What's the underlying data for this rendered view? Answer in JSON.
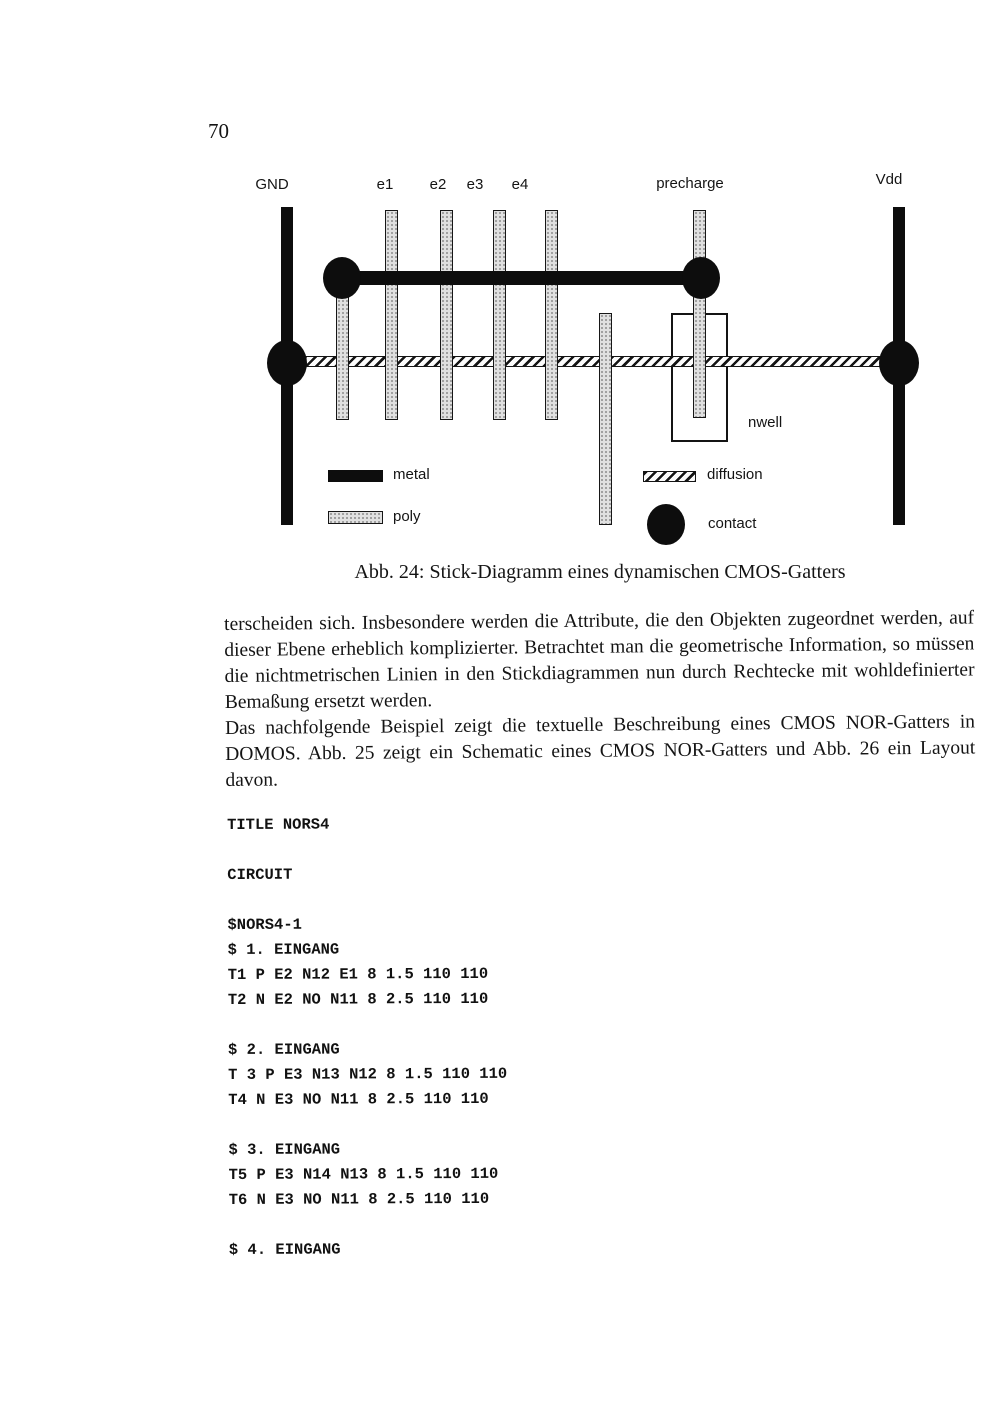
{
  "page": {
    "number": "70"
  },
  "diagram": {
    "signal_labels": {
      "gnd": "GND",
      "e1": "e1",
      "e2": "e2",
      "e3": "e3",
      "e4": "e4",
      "precharge": "precharge",
      "vdd": "Vdd"
    },
    "region_labels": {
      "nwell": "nwell"
    },
    "legend": {
      "metal": "metal",
      "poly": "poly",
      "diffusion": "diffusion",
      "contact": "contact"
    },
    "caption": "Abb. 24: Stick-Diagramm eines dynamischen CMOS-Gatters"
  },
  "body": {
    "paragraph1": "terscheiden sich. Insbesondere werden die Attribute, die den Objekten zugeordnet werden, auf dieser Ebene erheblich komplizierter. Betrachtet man die geometrische Information, so müssen die nichtmetrischen Linien in den Stickdiagrammen nun durch Rechtecke mit wohldefinierter Bemaßung ersetzt werden.",
    "paragraph2": "Das nachfolgende Beispiel zeigt die textuelle Beschreibung eines CMOS NOR-Gatters in DOMOS. Abb. 25 zeigt ein Schematic eines CMOS NOR-Gatters und Abb. 26 ein Layout davon."
  },
  "code": {
    "lines": [
      "TITLE NORS4",
      "",
      "CIRCUIT",
      "",
      "$NORS4-1",
      "$ 1. EINGANG",
      "T1 P E2 N12 E1 8 1.5 110 110",
      "T2 N E2 NO N11 8 2.5 110 110",
      "",
      "$ 2. EINGANG",
      "T 3 P E3 N13 N12 8 1.5 110 110",
      "T4 N E3 NO N11 8 2.5 110 110",
      "",
      "$ 3. EINGANG",
      "T5 P E3 N14 N13 8 1.5 110 110",
      "T6 N E3 NO N11 8 2.5 110 110",
      "",
      "$ 4. EINGANG"
    ]
  },
  "colors": {
    "ink": "#141414",
    "paper": "#ffffff",
    "poly_fill": "#e0e0e0"
  }
}
